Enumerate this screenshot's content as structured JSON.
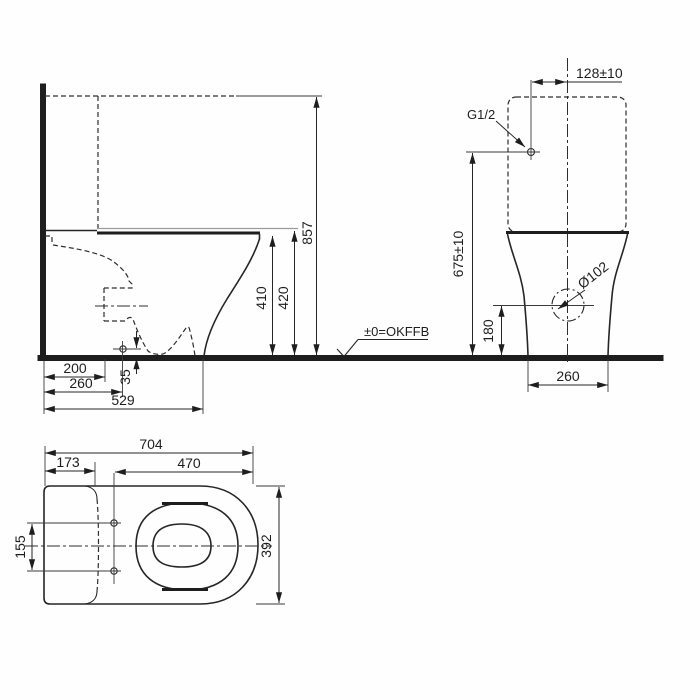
{
  "drawing": {
    "type": "toilet-installation-dimension-drawing",
    "views": {
      "side": {
        "total_height": "857",
        "rim_height": "410",
        "seat_height": "420",
        "outlet_setback": "200",
        "fixing_hole_setback": "260",
        "foot_depth": "529",
        "fixing_hole_height": "35"
      },
      "front": {
        "supply_offset": "128±10",
        "supply_thread": "G1/2",
        "supply_height": "675±10",
        "drain_diameter": "Ø102",
        "drain_height": "180",
        "base_width": "260",
        "floor_reference": "±0=OKFFB"
      },
      "plan": {
        "total_length": "704",
        "tank_depth": "173",
        "opening_length": "470",
        "fixing_hole_spacing": "155",
        "total_width": "392"
      }
    },
    "colors": {
      "line": "#262626",
      "gray_line": "#9a9a9a",
      "background": "#fefefe"
    }
  }
}
